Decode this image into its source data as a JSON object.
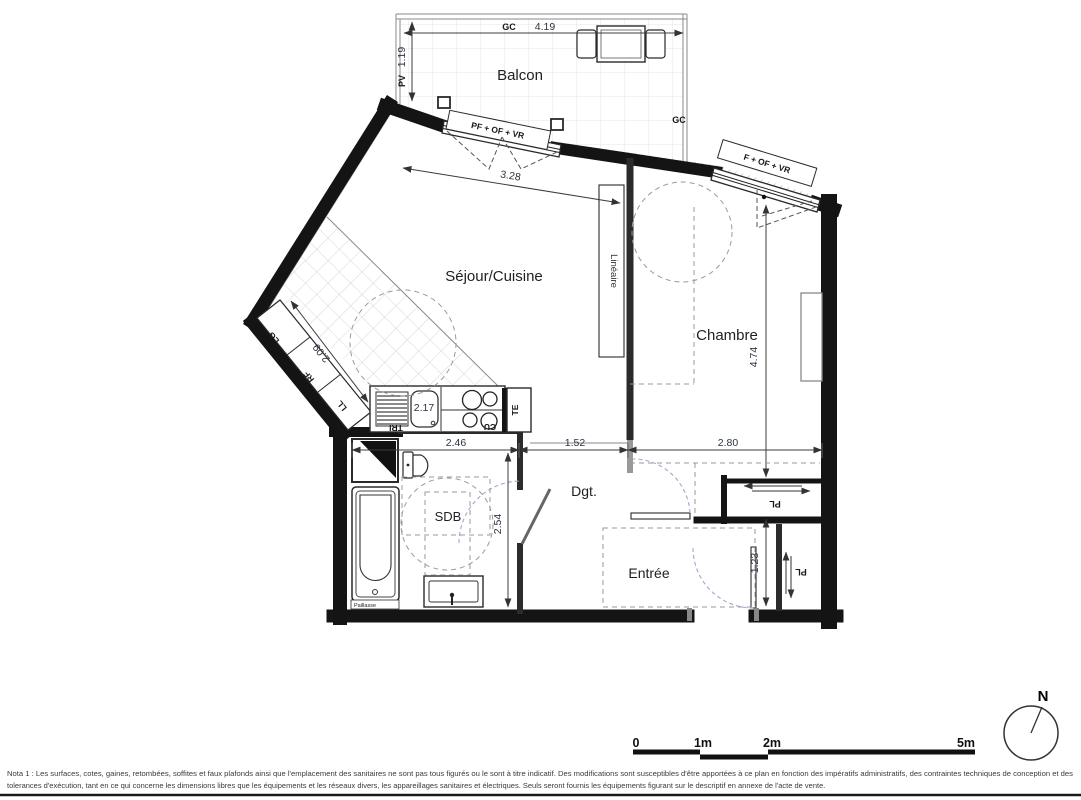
{
  "plan": {
    "rooms": {
      "balcony": "Balcon",
      "living_kitchen": "Séjour/Cuisine",
      "bedroom": "Chambre",
      "bathroom": "SDB",
      "hallway": "Dgt.",
      "entry": "Entrée"
    },
    "dimensions": {
      "balcony_width": "4.19",
      "balcony_depth": "1.19",
      "living_window_width": "3.28",
      "kitchen_counter_length": "2.09",
      "kitchen_worktop": "2.17",
      "bathroom_width": "2.46",
      "hallway_opening": "1.52",
      "bedroom_width": "2.80",
      "bathroom_depth": "2.54",
      "bedroom_depth": "4.74",
      "entry_closet_width": "1.23"
    },
    "annotations": {
      "gc_top": "GC",
      "gc_right": "GC",
      "pv": "PV",
      "living_window_type": "PF + OF + VR",
      "bedroom_window_type": "F + OF + VR",
      "linear_closet": "Linéaire",
      "lg": "LG",
      "rf": "RF",
      "ll": "LL",
      "tri": "TRI",
      "cu": "CU",
      "te": "TE",
      "pl_top": "PL",
      "pl_bottom": "PL",
      "paillasse": "Paillasse"
    }
  },
  "scale_bar": {
    "ticks": [
      "0",
      "1m",
      "2m",
      "5m"
    ]
  },
  "compass": {
    "north_label": "N"
  },
  "nota": {
    "line1": "Nota 1 : Les surfaces, cotes, gaines, retombées, soffites et faux plafonds ainsi que l'emplacement des sanitaires ne sont pas tous figurés ou le sont à titre indicatif. Des modifications sont susceptibles d'être apportées à ce plan en fonction des impératifs administratifs, des contraintes techniques de conception et des",
    "line2": "tolerances d'exécution, tant en ce qui concerne les dimensions libres que les équipements et les réseaux divers, les appareillages sanitaires et électriques. Seuls seront fournis les équipements figurant sur le descriptif en annexe de l'acte de vente."
  }
}
